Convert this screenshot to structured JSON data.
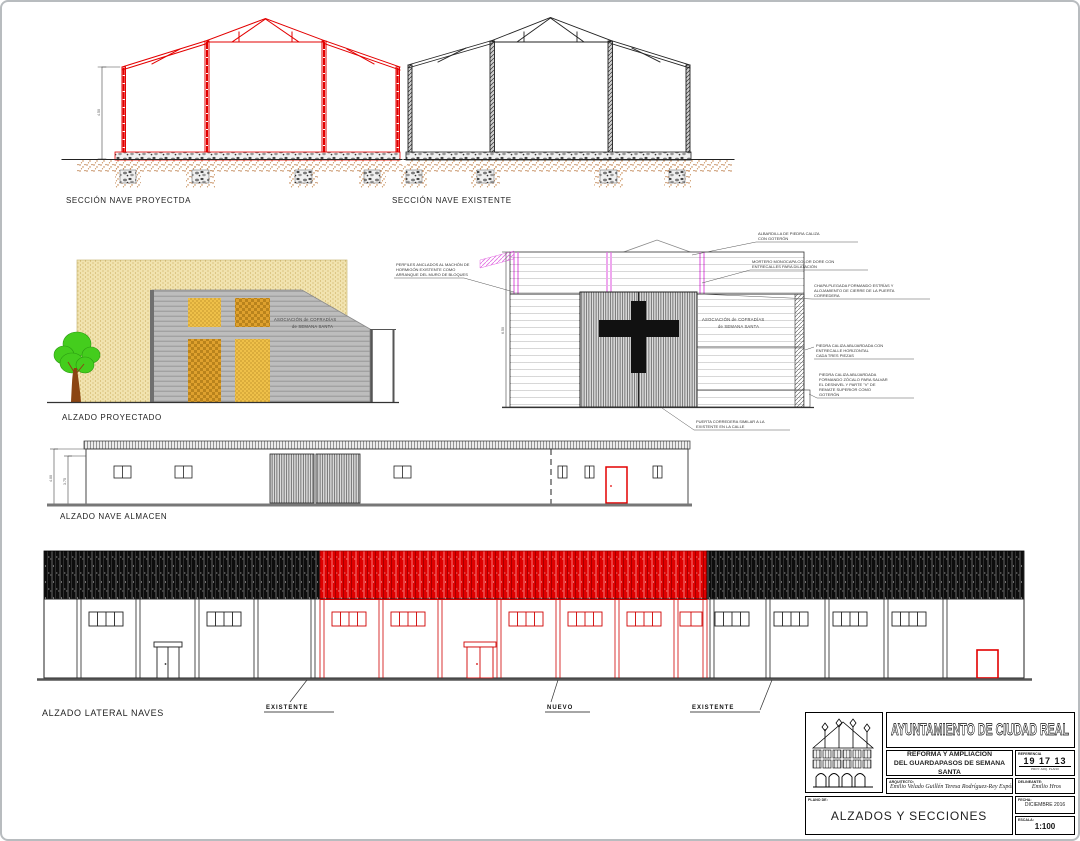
{
  "labels": {
    "seccion_proyectada": "SECCIÓN NAVE PROYECTDA",
    "seccion_existente": "SECCIÓN NAVE EXISTENTE",
    "alzado_proyectado": "ALZADO PROYECTADO",
    "alzado_nave_almacen": "ALZADO NAVE ALMACEN",
    "alzado_lateral_naves": "ALZADO LATERAL NAVES",
    "existente_left": "EXISTENTE",
    "nuevo": "NUEVO",
    "existente_right": "EXISTENTE"
  },
  "sign": [
    "ASOCIACIÓN de COFRADÍAS",
    "de SEMANA SANTA"
  ],
  "annotations": {
    "a1": [
      "ALBARDILLA DE PIEDRA CALIZA",
      "CON GOTERÓN"
    ],
    "a2": [
      "MORTERO MONOCAPA COLOR DORE CON",
      "ENTRECALLES PARA DILATACIÓN"
    ],
    "a3": [
      "CHAPA PLEGADA FORMANDO ESTRÍAS Y",
      "ALOJAMIENTO DE CIERRE DE LA PUERTA",
      "CORREDERA"
    ],
    "a4": [
      "PIEDRA CALIZA ABUJARDADA CON",
      "ENTRECALLE HORIZONTAL",
      "CADA TRES PIEZAS"
    ],
    "a5": [
      "PIEDRA CALIZA ABUJARDADA",
      "FORMANDO ZÓCALO PARA SALVAR",
      "EL DESNIVEL Y PARTE \"V\" DE",
      "REMATE SUPERIOR COMO",
      "GOTERÓN"
    ],
    "a6": [
      "PUERTA CORREDERA SIMILAR A LA",
      "EXISTENTE EN LA CALLE"
    ],
    "a7": [
      "PERFILES ANCLADOS AL MACHÓN DE",
      "HORMIGÓN EXISTENTE COMO",
      "ARRANQUE DEL MURO DE BLOQUES"
    ]
  },
  "dims": {
    "seccion": "4.50",
    "elev": "6.50",
    "almacen_total": "4.00",
    "almacen_int": "3.75"
  },
  "colors": {
    "new_red": "#e30000",
    "magenta": "#e26ee2",
    "earth": "#c07a3a",
    "tan_wall": "#f0e2ae",
    "gold": "#e8b33a",
    "facade_gray": "#bcbcbc",
    "tree_green": "#44cd1d"
  },
  "title_block": {
    "municipality": "AYUNTAMIENTO  DE  CIUDAD  REAL",
    "project_line1": "REFORMA Y AMPLIACIÓN",
    "project_line2": "DEL GUARDAPASOS DE SEMANA SANTA",
    "referencia_label": "REFERENCIA",
    "referencia_value": "19 17 13",
    "referencia_sub": "PROY.   ARQ.   PLANO",
    "arquitecto_label": "ARQUITECTO:",
    "arquitecto_names": "Emilio Velado Guillén      Teresa Rodríguez-Rey Expósito",
    "delineante_label": "DELINEANTE:",
    "delineante_name": "Emilio Hros",
    "plano_label": "PLANO DE:",
    "plano_value": "ALZADOS Y SECCIONES",
    "fecha_label": "FECHA:",
    "fecha_value": "DICIEMBRE 2016",
    "escala_label": "ESCALA:",
    "escala_value": "1:100"
  }
}
